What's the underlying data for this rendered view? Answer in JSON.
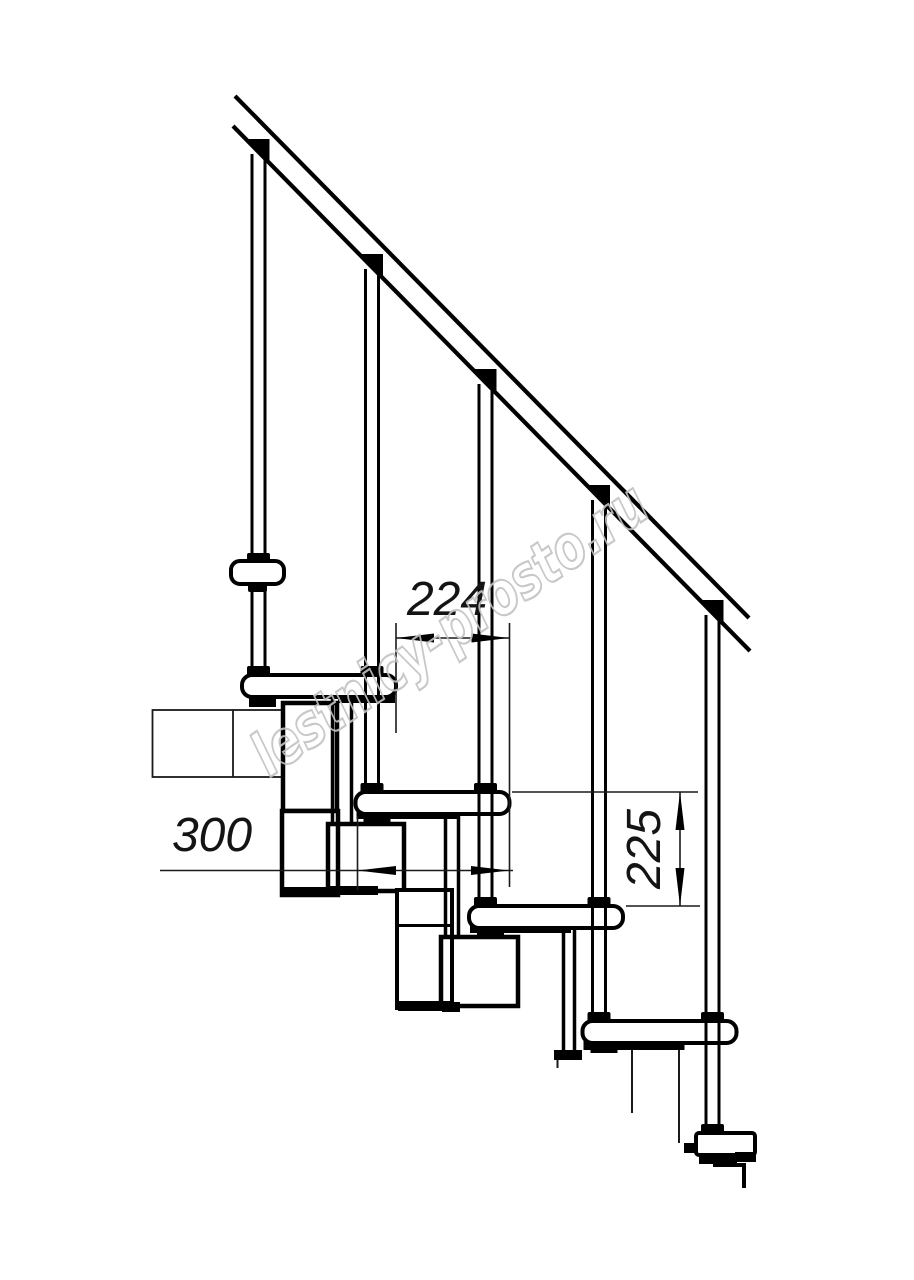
{
  "drawing": {
    "kind": "technical line drawing",
    "subject": "modular staircase side elevation with handrail, balusters, treads and support modules",
    "background_color": "#ffffff",
    "line_color": "#000000",
    "thin_line_color": "#1a1a1a",
    "counts": {
      "balusters": 5,
      "treads": 5
    },
    "dimensions": [
      {
        "id": "step-run",
        "value": "224",
        "orientation": "horizontal",
        "location": "between right edges of upper two treads"
      },
      {
        "id": "tread-depth",
        "value": "300",
        "orientation": "horizontal",
        "location": "across second tread"
      },
      {
        "id": "step-rise",
        "value": "225",
        "orientation": "vertical",
        "location": "between tops of second and third treads"
      }
    ],
    "watermark": {
      "text": "lestnicy-prosto.ru",
      "color": "#c3c3c3"
    }
  }
}
